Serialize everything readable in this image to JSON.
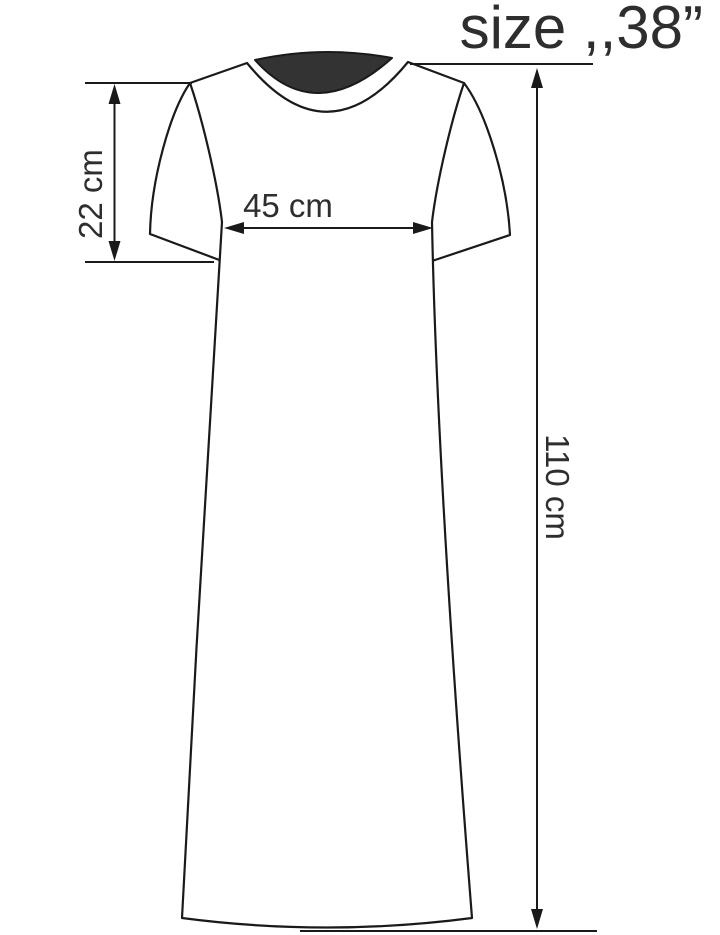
{
  "title": "size ,,38”",
  "measurements": {
    "sleeve_length": "22 cm",
    "chest_width": "45 cm",
    "total_length": "110 cm"
  },
  "colors": {
    "background": "#ffffff",
    "outline": "#1a1a1a",
    "text": "#2e2e2e",
    "back_neckline_fill": "#333333"
  }
}
